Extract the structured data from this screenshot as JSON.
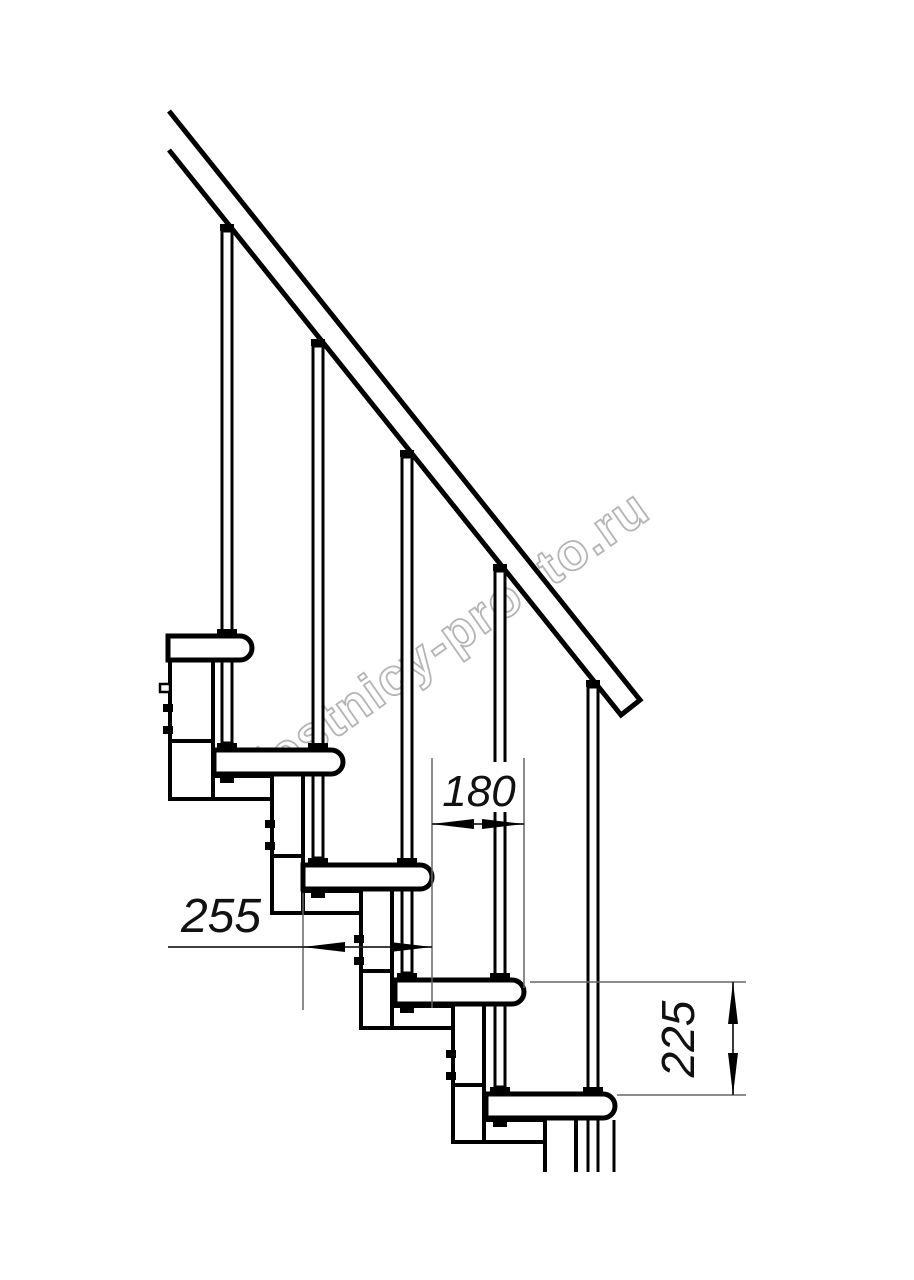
{
  "watermark": {
    "text": "lestnicy-prosto.ru",
    "color": "#b4b4b4"
  },
  "dimensions": {
    "step_run": {
      "label": "180"
    },
    "tread_length": {
      "label": "255"
    },
    "step_rise": {
      "label": "225"
    }
  },
  "style": {
    "background": "#ffffff",
    "line_color": "#000000",
    "dim_line_color": "#666666"
  }
}
